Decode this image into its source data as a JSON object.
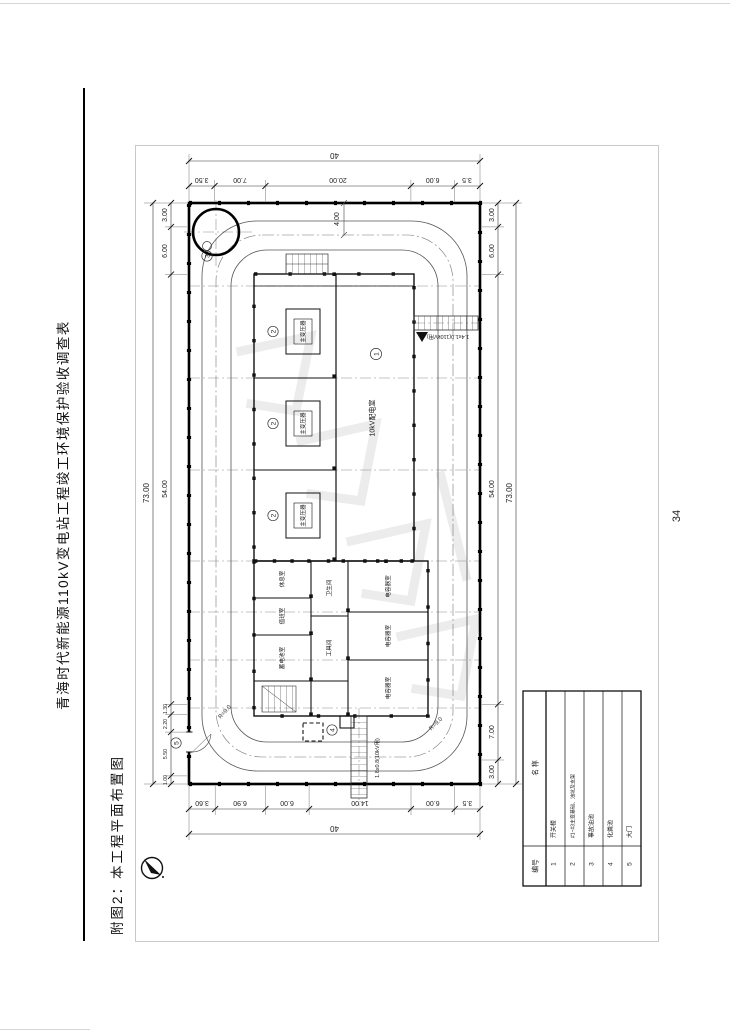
{
  "page": {
    "number": "34"
  },
  "header": {
    "title": "青海时代新能源110kV变电站工程竣工环境保护验收调查表"
  },
  "caption": {
    "text": "附图2：本工程平面布置图"
  },
  "drawing": {
    "dims": {
      "top_total": "40",
      "top": [
        "3.50",
        "7.00",
        "20.00",
        "6.00",
        "3.5"
      ],
      "bottom_total": "40",
      "bottom": [
        "3.60",
        "6.90",
        "6.00",
        "14.00",
        "6.00",
        "3.5"
      ],
      "left": [
        "3.00",
        "6.00",
        "54.00",
        "1.30",
        "2.20",
        "5.50",
        "1.00"
      ],
      "left_total": "73.00",
      "right": [
        "3.00",
        "6.00",
        "54.00",
        "7.00",
        "3.00"
      ],
      "right_total": "73.00",
      "road_width": "4.00",
      "radius": "R=9.0",
      "trench_right": "1.4x1.0(110kV用)",
      "trench_bottom": "1.8x0.8(10kV用)"
    },
    "labels": {
      "hall": "10kV配电室",
      "transformer": "主变压器",
      "capacitor": "电容器室",
      "room1": "休息室",
      "room2": "值班室",
      "room3": "蓄电池室",
      "room4": "卫生间",
      "room5": "工具间",
      "m1": "1",
      "m2": "2",
      "m3": "3",
      "m4": "4",
      "m5": "5"
    },
    "legend": {
      "col_no": "编号",
      "col_name": "名  称",
      "rows": [
        {
          "no": "1",
          "name": "开关楼"
        },
        {
          "no": "2",
          "name": "#1~#3主变基础、油坑及支架"
        },
        {
          "no": "3",
          "name": "事故油池"
        },
        {
          "no": "4",
          "name": "化粪池"
        },
        {
          "no": "5",
          "name": "大门"
        }
      ]
    }
  }
}
